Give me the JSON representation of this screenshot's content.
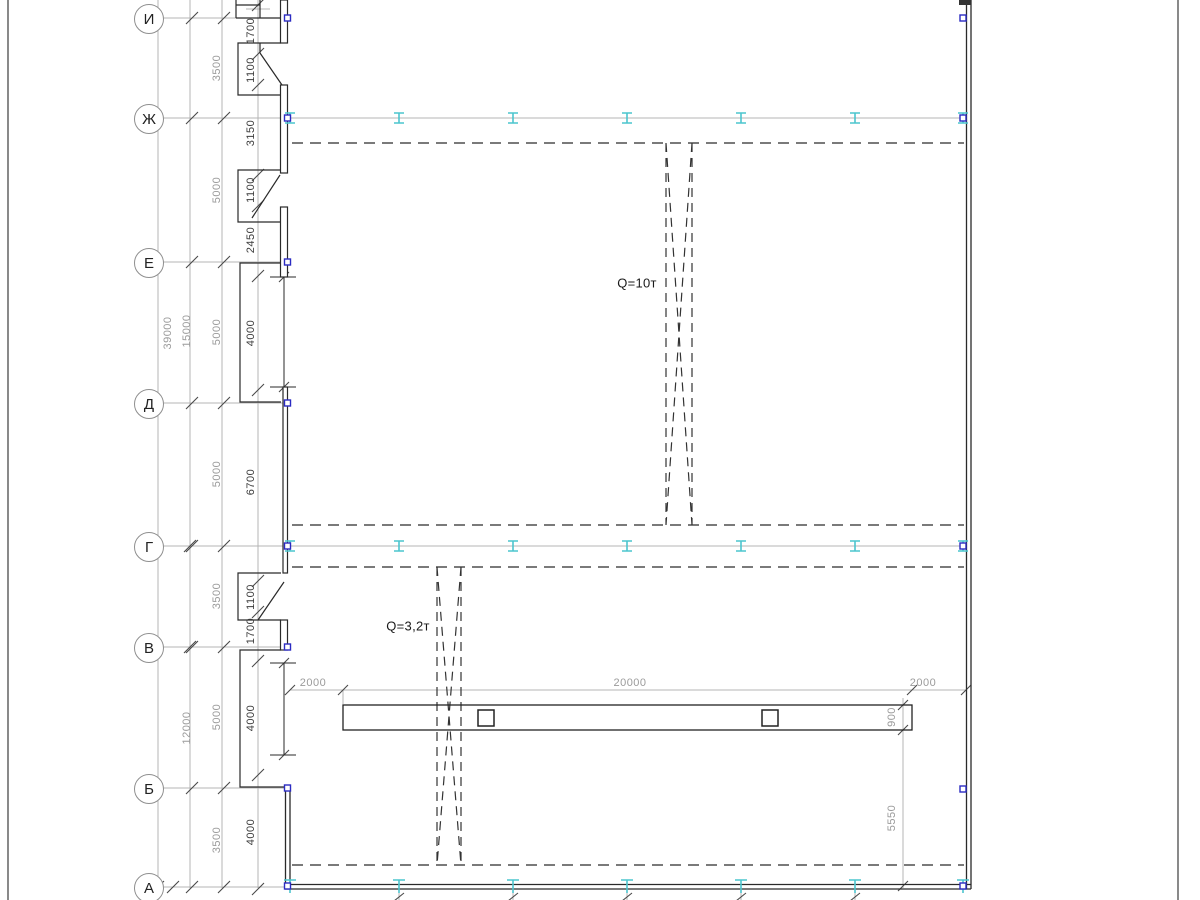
{
  "drawing": {
    "type": "structural-plan",
    "axes": [
      {
        "label": "И"
      },
      {
        "label": "Ж"
      },
      {
        "label": "Е"
      },
      {
        "label": "Д"
      },
      {
        "label": "Г"
      },
      {
        "label": "В"
      },
      {
        "label": "Б"
      },
      {
        "label": "А"
      }
    ],
    "cranes": [
      {
        "label": "Q=10т"
      },
      {
        "label": "Q=3,2т"
      }
    ],
    "dimensions": {
      "overall": [
        "39000",
        "15000",
        "12000"
      ],
      "axis_spacing": [
        "3500",
        "5000",
        "5000",
        "5000",
        "3500",
        "5000",
        "3500"
      ],
      "wall_segments": [
        "1700",
        "1100",
        "3150",
        "1100",
        "2450",
        "4000",
        "6700",
        "1100",
        "1700",
        "4000",
        "4000"
      ],
      "monorail": [
        "2000",
        "20000",
        "2000",
        "900",
        "5550"
      ]
    },
    "colors": {
      "column_anchor_marker": "#2b2bc2",
      "steel_column_symbol": "#4cc5ce",
      "dim_text_gray": "#9b9b9b",
      "dim_text_dark": "#3c3c3c",
      "line_dark": "#2a2a2a",
      "line_gray": "#b4b4b4"
    }
  }
}
